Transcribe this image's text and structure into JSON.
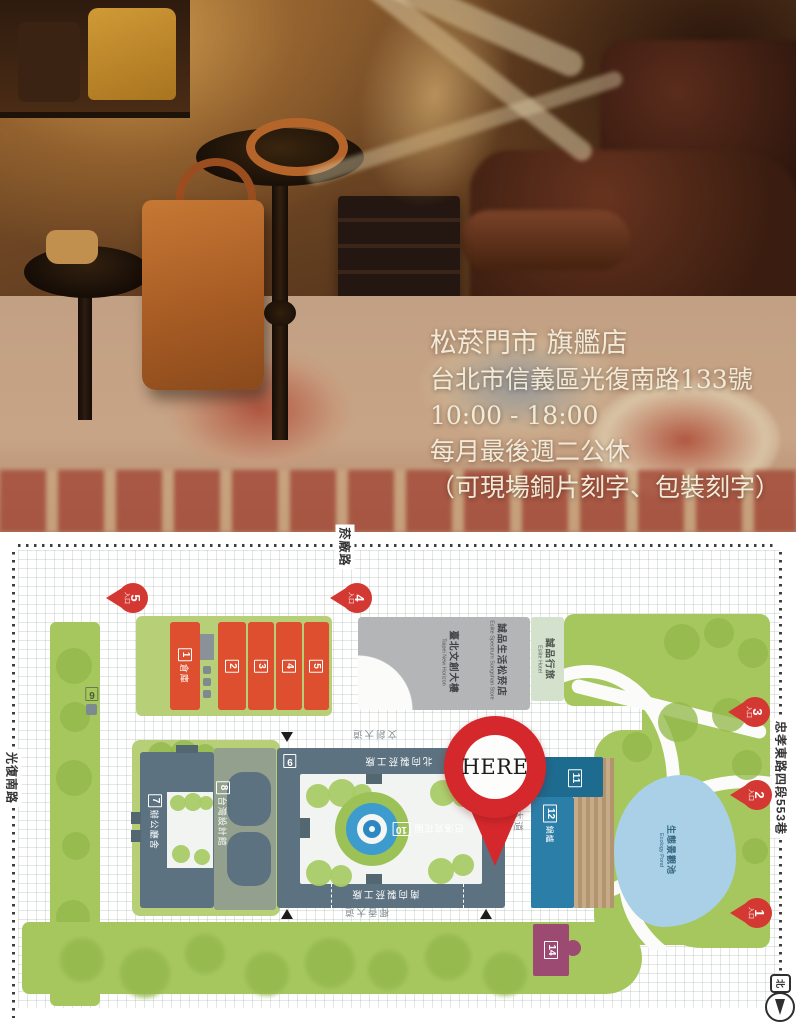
{
  "photo": {
    "lines": {
      "store": "松菸門市 旗艦店",
      "address": "台北市信義區光復南路133號",
      "hours": "10:00 - 18:00",
      "closed": "每月最後週二公休",
      "note": "（可現場銅片刻字、包裝刻字）"
    }
  },
  "map": {
    "here_label": "HERE",
    "compass_label": "北",
    "roads": {
      "yanchang": "菸廠路",
      "guangfu": "光復南路",
      "zhongxiao": "忠孝東路四段553巷",
      "wenchuang": "文創大道",
      "yexiang": "椰香大道",
      "yelin": "椰林大道"
    },
    "pins": [
      {
        "num": "1",
        "label": "入口"
      },
      {
        "num": "2",
        "label": "入口"
      },
      {
        "num": "3",
        "label": "入口"
      },
      {
        "num": "4",
        "label": "入口"
      },
      {
        "num": "5",
        "label": "入口"
      }
    ],
    "buildings": {
      "b1_num": "1",
      "b1_name": "倉庫",
      "b2_num": "2",
      "b3_num": "3",
      "b4_num": "4",
      "b5_num": "5",
      "b6_num": "6",
      "b7_num": "7",
      "b7_name": "辦公廳舍",
      "b8_num": "8",
      "b8_name": "台灣設計館",
      "b9_num": "9",
      "b10_num": "10",
      "b10_name": "巴洛克花園",
      "b11_num": "11",
      "b12_num": "12",
      "b12_name": "鍋爐",
      "b14_num": "14",
      "factory_north": "北向製菸工廠",
      "factory_south": "南向製菸工廠",
      "new_horizon_zh": "臺北文創大樓",
      "new_horizon_en": "Taipei New Horizon",
      "eslite_spectrum_zh": "誠品生活松菸店",
      "eslite_spectrum_en": "Eslite Spectrum Songshan Store",
      "eslite_hotel_zh": "誠品行旅",
      "eslite_hotel_en": "Eslite Hotel",
      "pond_zh": "生態景觀池",
      "pond_en": "Ecology Pond"
    },
    "colors": {
      "building_red": "#dd4f2e",
      "pin_red": "#d43832",
      "here_red": "#d5282c",
      "slate": "#5d7280",
      "park_green": "#a6c75e",
      "pad_green": "#b7d077",
      "blue_11": "#1e6b90",
      "blue_12": "#2b7ea7",
      "pond_blue": "#a9d0e6",
      "magenta_14": "#9c4a72",
      "gray_building": "#b3b5b6"
    }
  }
}
